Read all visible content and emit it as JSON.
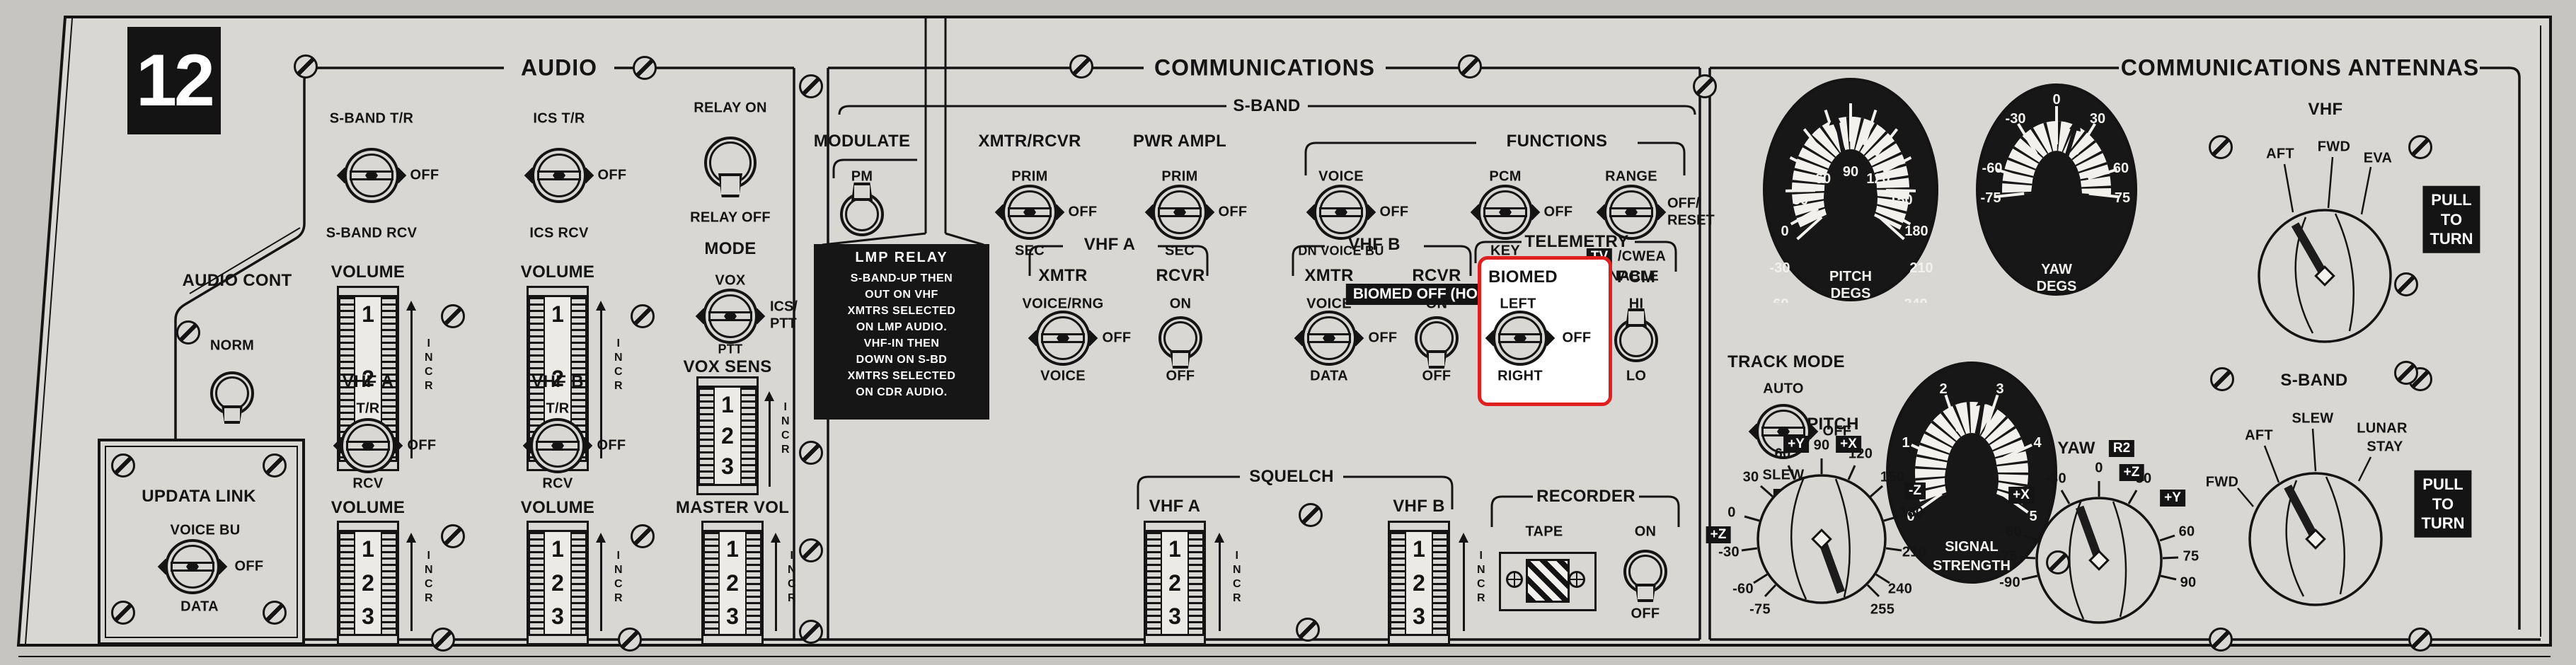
{
  "colors": {
    "panel": "#d8d7d4",
    "background": "#c6c5c2",
    "ink": "#141414",
    "highlight_red": "#e01f1f"
  },
  "panel": {
    "number": "12"
  },
  "common": {
    "volume": "VOLUME",
    "numbers": [
      "1",
      "2",
      "3"
    ],
    "incr": [
      "I",
      "N",
      "C",
      "R"
    ]
  },
  "audio": {
    "header": "AUDIO",
    "audio_cont": {
      "label": "AUDIO CONT",
      "top": "NORM",
      "bottom": "BU"
    },
    "sband_tr": {
      "top": "S-BAND T/R",
      "right": "OFF",
      "bottom": "S-BAND RCV"
    },
    "ics_tr": {
      "top": "ICS T/R",
      "right": "OFF",
      "bottom": "ICS RCV"
    },
    "relay": {
      "top": "RELAY ON",
      "bottom": "RELAY OFF"
    },
    "mode": {
      "label": "MODE",
      "top": "VOX",
      "right1": "ICS/",
      "right2": "PTT",
      "bottom": "PTT"
    },
    "vox_sens": {
      "label": "VOX SENS"
    },
    "vhf_a": {
      "header": "VHF A",
      "top": "T/R",
      "right": "OFF",
      "bottom": "RCV"
    },
    "vhf_b": {
      "header": "VHF B",
      "top": "T/R",
      "right": "OFF",
      "bottom": "RCV"
    },
    "master_vol": {
      "label": "MASTER VOL"
    },
    "updata": {
      "title": "UPDATA LINK",
      "top": "VOICE BU",
      "right": "OFF",
      "bottom": "DATA"
    }
  },
  "comm": {
    "header": "COMMUNICATIONS",
    "sband": "S-BAND",
    "modulate": {
      "header": "MODULATE",
      "top": "PM",
      "bottom": "FM",
      "bottom_tag": "TV"
    },
    "xmtr_rcvr": {
      "header": "XMTR/RCVR",
      "top": "PRIM",
      "right": "OFF",
      "bottom": "SEC"
    },
    "pwr_ampl": {
      "header": "PWR AMPL",
      "top": "PRIM",
      "right": "OFF",
      "bottom": "SEC"
    },
    "functions": {
      "header": "FUNCTIONS",
      "voice": {
        "top": "VOICE",
        "right": "OFF",
        "bottom": "DN VOICE BU"
      },
      "pcm": {
        "top": "PCM",
        "right": "OFF",
        "bottom": "KEY"
      },
      "range": {
        "top": "RANGE",
        "right1": "OFF/",
        "right2": "RESET",
        "tag": "TV",
        "bottom1": "/CWEA",
        "bottom2": "ENABLE"
      }
    },
    "biomed_tag": "BIOMED OFF (HOT MIC)",
    "lmp": {
      "title": "LMP RELAY",
      "lines": [
        "S-BAND-UP THEN",
        "OUT ON VHF",
        "XMTRS SELECTED",
        "ON LMP AUDIO.",
        "VHF-IN THEN",
        "DOWN ON S-BD",
        "XMTRS SELECTED",
        "ON CDR AUDIO."
      ]
    },
    "vhf_a": {
      "header": "VHF A",
      "xmtr": "XMTR",
      "rcvr": "RCVR",
      "xmtr_sw": {
        "top": "VOICE/RNG",
        "right": "OFF",
        "bottom": "VOICE"
      },
      "rcvr_sw": {
        "top": "ON",
        "bottom": "OFF"
      }
    },
    "vhf_b": {
      "header": "VHF B",
      "xmtr": "XMTR",
      "rcvr": "RCVR",
      "xmtr_sw": {
        "top": "VOICE",
        "right": "OFF",
        "bottom": "DATA"
      },
      "rcvr_sw": {
        "top": "ON",
        "bottom": "OFF"
      }
    },
    "telemetry": {
      "header": "TELEMETRY",
      "biomed": {
        "label": "BIOMED",
        "top": "LEFT",
        "right": "OFF",
        "bottom": "RIGHT"
      },
      "pcm": {
        "label": "PCM",
        "top": "HI",
        "bottom": "LO"
      }
    },
    "squelch": {
      "header": "SQUELCH",
      "vhf_a": "VHF A",
      "vhf_b": "VHF B"
    },
    "recorder": {
      "header": "RECORDER",
      "tape": "TAPE",
      "on": "ON",
      "off": "OFF"
    }
  },
  "antennas": {
    "header": "COMMUNICATIONS ANTENNAS",
    "pitch_gauge": {
      "caption1": "PITCH",
      "caption2": "DEGS",
      "labels": [
        "-75",
        "-60",
        "-30",
        "0",
        "30",
        "60",
        "90",
        "120",
        "150",
        "180",
        "210",
        "240",
        "255"
      ]
    },
    "yaw_gauge": {
      "caption1": "YAW",
      "caption2": "DEGS",
      "labels": [
        "-75",
        "-60",
        "-30",
        "0",
        "30",
        "60",
        "75"
      ]
    },
    "signal_gauge": {
      "caption1": "SIGNAL",
      "caption2": "STRENGTH",
      "labels": [
        "0",
        "1",
        "2",
        "3",
        "4",
        "5"
      ]
    },
    "vhf_knob": {
      "label": "VHF",
      "pos": [
        "AFT",
        "FWD",
        "EVA"
      ]
    },
    "pull_to_turn": [
      "PULL",
      "TO",
      "TURN"
    ],
    "track_mode": {
      "header": "TRACK MODE",
      "top": "AUTO",
      "right": "OFF",
      "bottom": "SLEW",
      "tag": "R1"
    },
    "pitch_knob": {
      "label": "PITCH",
      "tag_py": "+Y",
      "tag_px": "+X",
      "tag_mz": "-Z",
      "tag_pz": "+Z",
      "labels": [
        "0",
        "30",
        "60",
        "90",
        "120",
        "150",
        "180",
        "210",
        "240",
        "255",
        "-30",
        "-60",
        "-75"
      ]
    },
    "yaw_knob": {
      "label": "YAW",
      "tag": "R2",
      "tag_pz": "+Z",
      "tag_px": "+X",
      "tag_py": "+Y",
      "labels": [
        "0",
        "30",
        "60",
        "75",
        "90",
        "-30",
        "-60",
        "-75",
        "-90"
      ]
    },
    "sband_knob": {
      "label": "S-BAND",
      "pos_slew": "SLEW",
      "pos_aft": "AFT",
      "pos_lunar1": "LUNAR",
      "pos_lunar2": "STAY",
      "pos_fwd": "FWD"
    }
  }
}
